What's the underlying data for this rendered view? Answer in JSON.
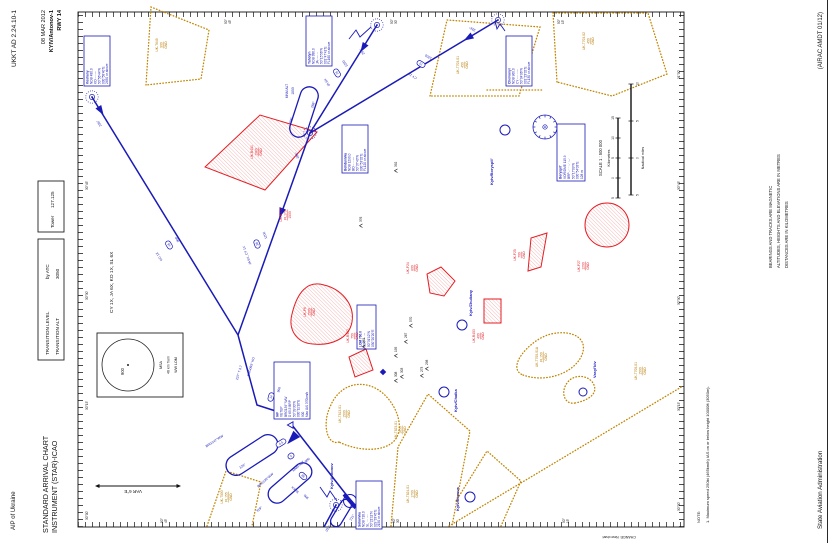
{
  "palette": {
    "route_blue": "#1a1ab8",
    "label_blue": "#2222c0",
    "area_red": "#e31e24",
    "area_brown": "#b87a00",
    "ink": "#111111"
  },
  "header": {
    "aip": "AIP of Ukraine",
    "title1": "STANDARD ARRIVAL CHART",
    "title2": "INSTRUMENT (STAR)-ICAO",
    "doc": "UKKT AD 2.24.10-1",
    "date": "08 MAR 2012",
    "airport": "KYIV/Antonov-1",
    "rwy": "RWY 14"
  },
  "info": {
    "transition_level_label": "TRANSITION LEVEL",
    "transition_level_value": "by ATC",
    "transition_alt_label": "TRANSITION ALT",
    "transition_alt_value": "3050",
    "tower_label": "Tower",
    "tower_value": "127.125",
    "stars": "CY 1X, JA 6X, KO 1X, SL 6X",
    "var": "VAR 6°E"
  },
  "msa": {
    "value": "900",
    "lines": [
      "MSA",
      "46 km from",
      "WW LOM"
    ]
  },
  "scale": {
    "title": "SCALE 1 : 500 000",
    "km_label": "Kilometres",
    "nm_label": "Nautical miles",
    "km_ticks": [
      "5",
      "0",
      "5",
      "10",
      "15"
    ],
    "nm_ticks": [
      "5",
      "0",
      "5",
      "10"
    ]
  },
  "notes": {
    "heading": "NOTE:",
    "line1": "1. Maximum speed 250kt (465km/h) IAS on or below height 10000ft (3050m).",
    "block": [
      "BEARINGS AND TRACKS ARE MAGNETIC",
      "ALTITUDES, HEIGHTS AND ELEVATIONS ARE IN METRES",
      "DISTANCES ARE IN KILOMETRES"
    ]
  },
  "footer": {
    "authority": "State Aviation Administration",
    "amdt": "(AIRAC AMDT 01/12)",
    "change": "CHANGE: New chart"
  },
  "map": {
    "graticule": {
      "top": [
        {
          "x": 23,
          "t": "30°00'"
        },
        {
          "x": 133,
          "t": "30°15'"
        },
        {
          "x": 243,
          "t": "30°30'"
        },
        {
          "x": 353,
          "t": "30°45'"
        }
      ],
      "bottom": [
        {
          "x": 32,
          "t": "30°00'"
        },
        {
          "x": 132,
          "t": "30°15'"
        },
        {
          "x": 238,
          "t": "30°30'"
        },
        {
          "x": 353,
          "t": "30°45'"
        },
        {
          "x": 464,
          "t": "31°00'"
        }
      ],
      "left": [
        {
          "y": 163,
          "a": "50°",
          "b": "45'"
        },
        {
          "y": 395,
          "a": "50°",
          "b": "30'"
        },
        {
          "y": 565,
          "a": "50°",
          "b": "15'"
        }
      ],
      "right": [
        {
          "y": 227,
          "a": "50°",
          "b": "45'"
        },
        {
          "y": 393,
          "a": "50°",
          "b": "30'"
        },
        {
          "y": 560,
          "a": "50°",
          "b": "15'"
        }
      ]
    },
    "navaid_boxes": [
      {
        "x": 457,
        "y": 84,
        "w": 50,
        "h": 26,
        "lines": [
          "Koshany",
          "NDB 480.0",
          "KO -·- ---",
          "50°56'44\"N",
          "030°58'40\"E",
          "2450 or above"
        ]
      },
      {
        "x": 477,
        "y": 306,
        "w": 50,
        "h": 26,
        "lines": [
          "Yahotyn",
          "NDB 386.0",
          "JA ·--- ·-",
          "50°15'56\"N",
          "031°47'41\"E",
          "FL160 or above"
        ]
      },
      {
        "x": 457,
        "y": 506,
        "w": 50,
        "h": 26,
        "lines": [
          "Chervonyi",
          "NDB 960.0",
          "CY -·-· -·--",
          "50°04'06\"N",
          "031°23'32\"E",
          "FL130 or above"
        ]
      },
      {
        "x": 370,
        "y": 342,
        "w": 48,
        "h": 26,
        "lines": [
          "Bohdanivka",
          "NDB 1290.0",
          "BO -··· ---",
          "50°37'43\"N",
          "030°53'32\"E",
          "FL120 or above"
        ]
      },
      {
        "x": 14,
        "y": 356,
        "w": 48,
        "h": 26,
        "lines": [
          "Solovivka",
          "NDB 718.0",
          "SL ··· ·-··",
          "50°21'11\"N",
          "029°33'45\"E",
          "2150 or above"
        ]
      },
      {
        "x": 362,
        "y": 557,
        "w": 57,
        "h": 28,
        "lines": [
          "Boryspil'",
          "VOR/DME 115.9",
          "BRP -··· ·-· ·--·",
          "50°17'09\"N",
          "030°54'03\"E",
          "128 m"
        ]
      },
      {
        "x": 194,
        "y": 357,
        "w": 44,
        "h": 19,
        "lines": [
          "LOM 760.0",
          "WW ·-- ·--",
          "50°31'12\"N",
          "030°20'20\"E"
        ]
      },
      {
        "x": 124,
        "y": 274,
        "w": 57,
        "h": 36,
        "lines": [
          "IAF",
          "VETEP",
          "BRG139° WW",
          "D 65.5 BRP",
          "50°39'30\"N",
          "030°11'10\"E",
          "900",
          "Max IAS 370km/h"
        ]
      }
    ],
    "area_labels": [
      {
        "cls": "red",
        "x": 391,
        "y": 253,
        "lines": [
          "UK-R451",
          "1080",
          "GND"
        ]
      },
      {
        "cls": "red",
        "x": 207,
        "y": 349,
        "lines": [
          "UK-R452",
          "750",
          "GND"
        ]
      },
      {
        "cls": "red",
        "x": 328,
        "y": 282,
        "lines": [
          "UK-R772",
          "FL170",
          "1500"
        ]
      },
      {
        "cls": "red",
        "x": 231,
        "y": 306,
        "lines": [
          "UK-P6",
          "1500",
          "GND"
        ]
      },
      {
        "cls": "red",
        "x": 275,
        "y": 409,
        "lines": [
          "UK-P24",
          "800",
          "GND"
        ]
      },
      {
        "cls": "red",
        "x": 288,
        "y": 516,
        "lines": [
          "UK-P25",
          "700",
          "GND"
        ]
      },
      {
        "cls": "red",
        "x": 277,
        "y": 580,
        "lines": [
          "UK-P27",
          "1200",
          "GND"
        ]
      },
      {
        "cls": "red",
        "x": 207,
        "y": 475,
        "lines": [
          "UK-R453",
          "400",
          "GND"
        ]
      },
      {
        "cls": "brn",
        "x": 498,
        "y": 158,
        "lines": [
          "UK-T649",
          "900",
          "GND"
        ]
      },
      {
        "cls": "brn",
        "x": 478,
        "y": 459,
        "lines": [
          "UK-T703-01",
          "450",
          "GND"
        ]
      },
      {
        "cls": "brn",
        "x": 502,
        "y": 585,
        "lines": [
          "UK-T703-02",
          "450",
          "GND"
        ]
      },
      {
        "cls": "brn",
        "x": 129,
        "y": 341,
        "lines": [
          "UK-T813-01",
          "1500",
          "GND"
        ]
      },
      {
        "cls": "brn",
        "x": 113,
        "y": 397,
        "lines": [
          "UK-T823-01",
          "1850",
          "GND"
        ]
      },
      {
        "cls": "brn",
        "x": 49,
        "y": 409,
        "lines": [
          "UK-T824-01",
          "1700",
          "GND"
        ]
      },
      {
        "cls": "brn",
        "x": 186,
        "y": 538,
        "lines": [
          "UK-T705-01A",
          "FL150",
          "GND"
        ]
      },
      {
        "cls": "brn",
        "x": 172,
        "y": 637,
        "lines": [
          "UK-T705-01",
          "1500",
          "GND"
        ]
      },
      {
        "cls": "brn",
        "x": 46,
        "y": 223,
        "lines": [
          "UK-T500",
          "FL155",
          "GND"
        ]
      }
    ],
    "route_labels": [
      {
        "t": "236°",
        "x": 420,
        "y": 100,
        "r": -31
      },
      {
        "t": "KO 1X",
        "x": 287,
        "y": 160,
        "r": -31
      },
      {
        "t": "900",
        "x": 304,
        "y": 178,
        "r": -31
      },
      {
        "t": "JA 6X, CY 1X",
        "x": 288,
        "y": 248,
        "r": -20
      },
      {
        "t": "1200",
        "x": 308,
        "y": 266,
        "r": -20
      },
      {
        "t": "286°",
        "x": 388,
        "y": 298,
        "r": -20
      },
      {
        "t": "297°",
        "x": 492,
        "y": 363,
        "r": -32
      },
      {
        "t": "JA 6X",
        "x": 461,
        "y": 328,
        "r": -32
      },
      {
        "t": "1200",
        "x": 480,
        "y": 346,
        "r": -32
      },
      {
        "t": "326°",
        "x": 515,
        "y": 473,
        "r": -59
      },
      {
        "t": "CY 1X",
        "x": 468,
        "y": 413,
        "r": -59
      },
      {
        "t": "1200",
        "x": 487,
        "y": 429,
        "r": -59
      },
      {
        "t": "237° T 3.7",
        "x": 170,
        "y": 240,
        "r": 16
      },
      {
        "t": "BRG055° KO",
        "x": 176,
        "y": 252,
        "r": 16
      },
      {
        "t": "900",
        "x": 153,
        "y": 280,
        "r": 16
      },
      {
        "t": "SL 6X",
        "x": 54,
        "y": 296,
        "r": -47
      },
      {
        "t": "900",
        "x": 47,
        "y": 307,
        "r": -47
      },
      {
        "t": "BRG147°WW",
        "x": 101,
        "y": 215,
        "r": 57
      },
      {
        "t": "139°",
        "x": 76,
        "y": 243,
        "r": 57
      },
      {
        "t": "BRG130°WW",
        "x": 62,
        "y": 266,
        "r": 49
      },
      {
        "t": "319°",
        "x": 33,
        "y": 260,
        "r": 49
      },
      {
        "t": "MNM ALT",
        "x": 76,
        "y": 299,
        "r": 49
      },
      {
        "t": "900",
        "x": 82,
        "y": 308,
        "r": 49
      },
      {
        "t": "MNM ALT",
        "x": 452,
        "y": 288,
        "r": 0
      },
      {
        "t": "1850",
        "x": 452,
        "y": 294,
        "r": 0
      },
      {
        "t": "108°",
        "x": 422,
        "y": 292,
        "r": 18
      },
      {
        "t": "288°",
        "x": 438,
        "y": 314,
        "r": 18
      },
      {
        "t": "031°",
        "x": 14,
        "y": 329,
        "r": 31
      },
      {
        "t": "211°",
        "x": 25,
        "y": 353,
        "r": 31
      }
    ],
    "dist_markers": [
      {
        "v": "46",
        "x": 298,
        "y": 169,
        "r": -31
      },
      {
        "v": "38",
        "x": 299,
        "y": 257,
        "r": -20
      },
      {
        "v": "76",
        "x": 470,
        "y": 337,
        "r": -32
      },
      {
        "v": "72",
        "x": 479,
        "y": 421,
        "r": -59
      },
      {
        "v": "14",
        "x": 146,
        "y": 271,
        "r": 16
      },
      {
        "v": "4.5",
        "x": 100,
        "y": 281,
        "r": 57
      },
      {
        "v": "5",
        "x": 87,
        "y": 291,
        "r": 49
      },
      {
        "v": "98",
        "x": 67,
        "y": 303,
        "r": -47
      }
    ],
    "spot_heights": [
      {
        "v": "392",
        "x": 376,
        "y": 397
      },
      {
        "v": "376",
        "x": 321,
        "y": 362
      },
      {
        "v": "570",
        "x": 221,
        "y": 412
      },
      {
        "v": "261",
        "x": 200,
        "y": 365
      },
      {
        "v": "195",
        "x": 191,
        "y": 397
      },
      {
        "v": "267",
        "x": 205,
        "y": 407
      },
      {
        "v": "303",
        "x": 170,
        "y": 403
      },
      {
        "v": "308",
        "x": 166,
        "y": 397
      },
      {
        "v": "273",
        "x": 171,
        "y": 423
      },
      {
        "v": "298",
        "x": 178,
        "y": 428
      }
    ],
    "ndb_positions": [
      {
        "x": 446,
        "y": 92
      },
      {
        "x": 518,
        "y": 377
      },
      {
        "x": 523,
        "y": 498
      },
      {
        "x": 410,
        "y": 310
      },
      {
        "x": 38,
        "y": 336
      }
    ],
    "vor": {
      "x": 416,
      "y": 545
    },
    "airports": [
      {
        "label": "Kyiv/Antonov",
        "x": 42,
        "y": 350,
        "lx": 54,
        "ly": 333,
        "rwy": true
      },
      {
        "label": "Kyiv/Boryspil'",
        "x": 413,
        "y": 505,
        "lx": 358,
        "ly": 493
      },
      {
        "label": "Kyiv/Chaika",
        "x": 151,
        "y": 444,
        "lx": 131,
        "ly": 457
      },
      {
        "label": "Kyiv/Zhuliany",
        "x": 218,
        "y": 462,
        "lx": 227,
        "ly": 472
      },
      {
        "label": "Kyiv/Buzova",
        "x": 46,
        "y": 470,
        "lx": 32,
        "ly": 459
      }
    ],
    "towns": [
      {
        "label": "Vasyl'kiv",
        "x": 151,
        "y": 583,
        "lx": 165,
        "ly": 596
      }
    ]
  }
}
